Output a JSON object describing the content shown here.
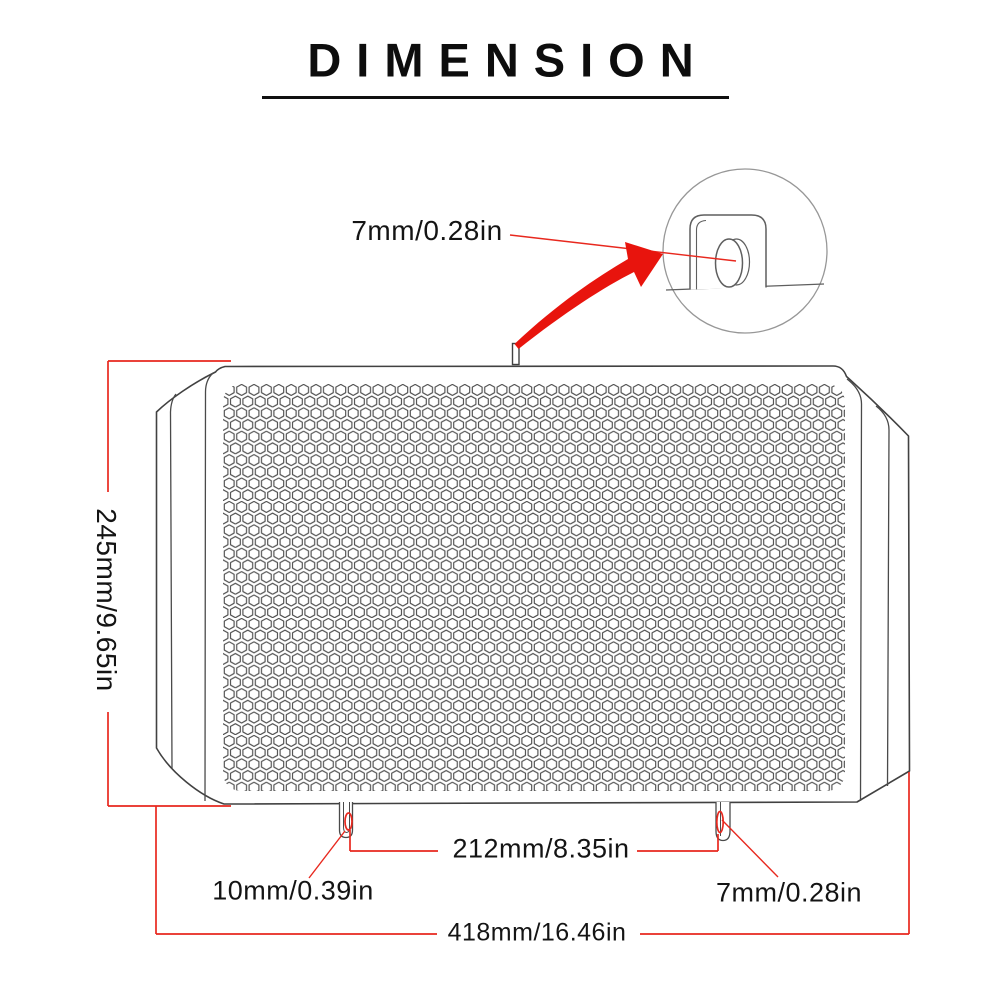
{
  "header": {
    "title": "DIMENSION"
  },
  "annotations": {
    "pin_size": "7mm/0.28in",
    "height": "245mm/9.65in",
    "mount_tab_spacing": "212mm/8.35in",
    "left_tab_size": "10mm/0.39in",
    "right_tab_size": "7mm/0.28in",
    "total_width": "418mm/16.46in"
  },
  "drawing": {
    "subject": "motorcycle radiator guard grille with honeycomb mesh",
    "detail_view": "magnified circle showing mounting tab with oval hole",
    "icons": [
      "magnify-arrow-icon",
      "detail-circle-icon",
      "leader-line-icon"
    ]
  },
  "colors": {
    "accent_red": "#e8281e",
    "arrow_red": "#e8140d",
    "outline_dark": "#414141",
    "mesh_gray": "#4f4f4f",
    "detail_gray": "#5f5f5f",
    "text": "#141414",
    "background": "#ffffff"
  }
}
